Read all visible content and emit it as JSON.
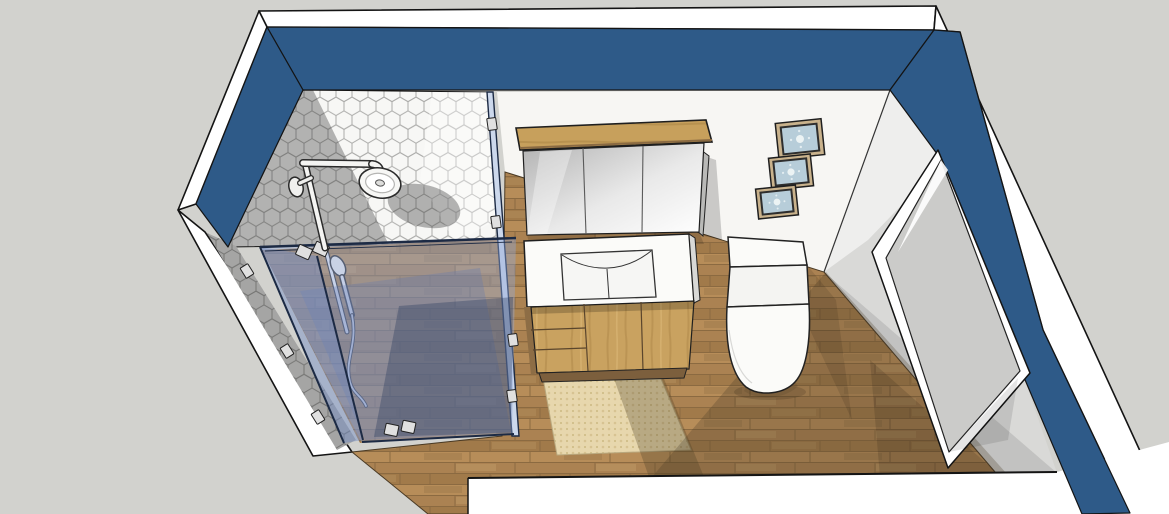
{
  "scene": {
    "title": "3D bathroom interior design model - aerial three-quarter view",
    "render_style": "sketchup-line-render",
    "room": "bathroom"
  },
  "palette": {
    "background": "#d2d2ce",
    "wall_outer_white": "#ffffff",
    "wall_paint_navy": "#2e5a88",
    "wall_interior_white": "#f7f6f3",
    "wall_interior_gray": "#d9d9d7",
    "door_leaf_gray": "#cbcbc9",
    "tile_white": "#f7f7f5",
    "tile_grout": "#ababa9",
    "floor_wood": "#aa8152",
    "cabinet_oak": "#c9a260",
    "kickboard": "#7c5f3d",
    "porcelain": "#fbfbf9",
    "bath_mat": "#e7d7ad",
    "art_frame_wood": "#c9b28c",
    "art_print_blue": "#b7cdd9",
    "glass_light": "#91a8d6",
    "glass_mid": "#627aaf",
    "glass_shadow": "#2f3e60",
    "glass_edge": "#1c2a44",
    "edge_outline": "#141414",
    "metal_hardware": "#e0e0e0"
  },
  "objects": {
    "walls": {
      "label": "navy painted walls with white outer shell",
      "paint": "#2e5a88"
    },
    "shower": {
      "label": "corner walk-in shower",
      "wall_finish": "white hexagon mosaic tile",
      "glass": "frameless tinted glass enclosure",
      "hardware_clamps": 11,
      "fixtures": [
        "rain shower head",
        "shower arm",
        "slide rail hand shower"
      ]
    },
    "mirror_cabinet": {
      "label": "mirrored wall cabinet",
      "doors": 3,
      "top": "oak shelf"
    },
    "vanity": {
      "label": "oak vanity with integrated basin",
      "drawers": 3,
      "doors": 2,
      "basin": "white rectangular"
    },
    "toilet": {
      "label": "back-to-wall toilet with cistern"
    },
    "wall_art": {
      "label": "framed blue tile prints",
      "count": 3
    },
    "bath_mat": {
      "label": "beige textured bath mat"
    },
    "floor": {
      "label": "oak plank flooring"
    },
    "door": {
      "label": "open doorway in right wall with door leaf"
    }
  }
}
